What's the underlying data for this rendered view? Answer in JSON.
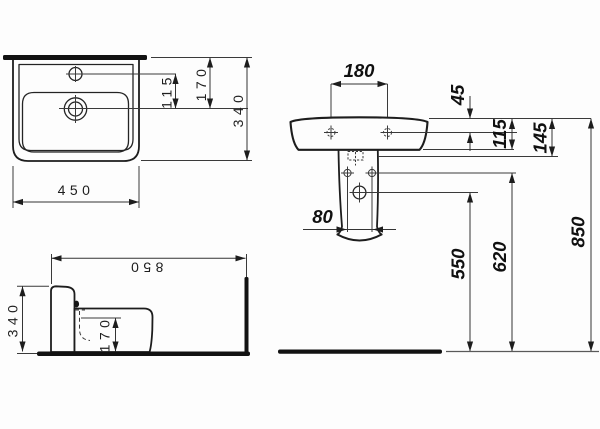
{
  "drawing": {
    "plan_view": {
      "faucet_to_drain": "115",
      "rim_to_drain": "170",
      "depth": "340",
      "width": "450"
    },
    "side_view": {
      "height_from_floor": "850",
      "depth": "340",
      "drain_height": "170"
    },
    "front_view": {
      "tap_hole_spacing": "180",
      "rim_to_tap_holes": "45",
      "rim_to_apron": "115",
      "rim_to_mount": "145",
      "pedestal_hole_spacing": "80",
      "floor_to_trap": "550",
      "floor_to_fixing": "620",
      "floor_to_rim": "850"
    }
  }
}
